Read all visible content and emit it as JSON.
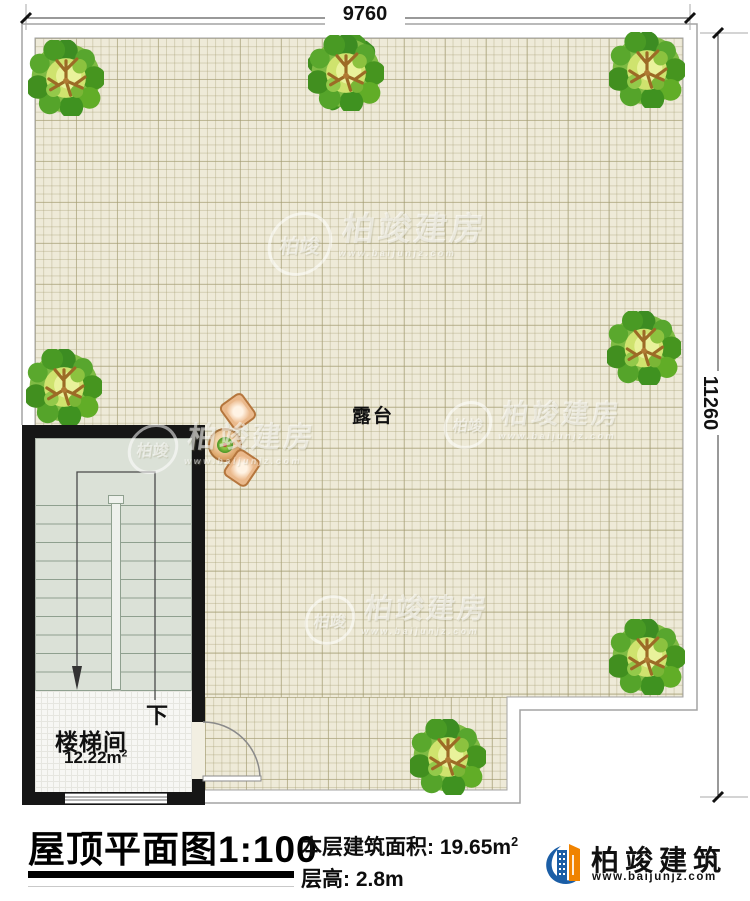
{
  "plan": {
    "dim_top": "9760",
    "dim_right": "11260",
    "terrace_label": "露台",
    "stair_room_label": "楼梯间",
    "stair_room_area": "12.22m",
    "stair_room_area_sup": "2",
    "down_label": "下"
  },
  "title_block": {
    "title": "屋顶平面图1:100",
    "area_label": "本层建筑面积:",
    "area_value": "19.65m",
    "area_sup": "2",
    "floor_height_label": "层高:",
    "floor_height_value": "2.8m"
  },
  "logo": {
    "name": "柏竣建筑",
    "website": "www.baijunjz.com"
  },
  "watermark": {
    "badge": "柏竣",
    "text": "柏竣建房",
    "url": "www.baijunjz.com"
  },
  "colors": {
    "wall": "#161616",
    "terrace_floor": "#eeead8",
    "stair_floor": "#dbe1d7",
    "tree_green": "#57a62c",
    "logo_blue": "#1b5ea6",
    "logo_orange": "#f08300"
  }
}
